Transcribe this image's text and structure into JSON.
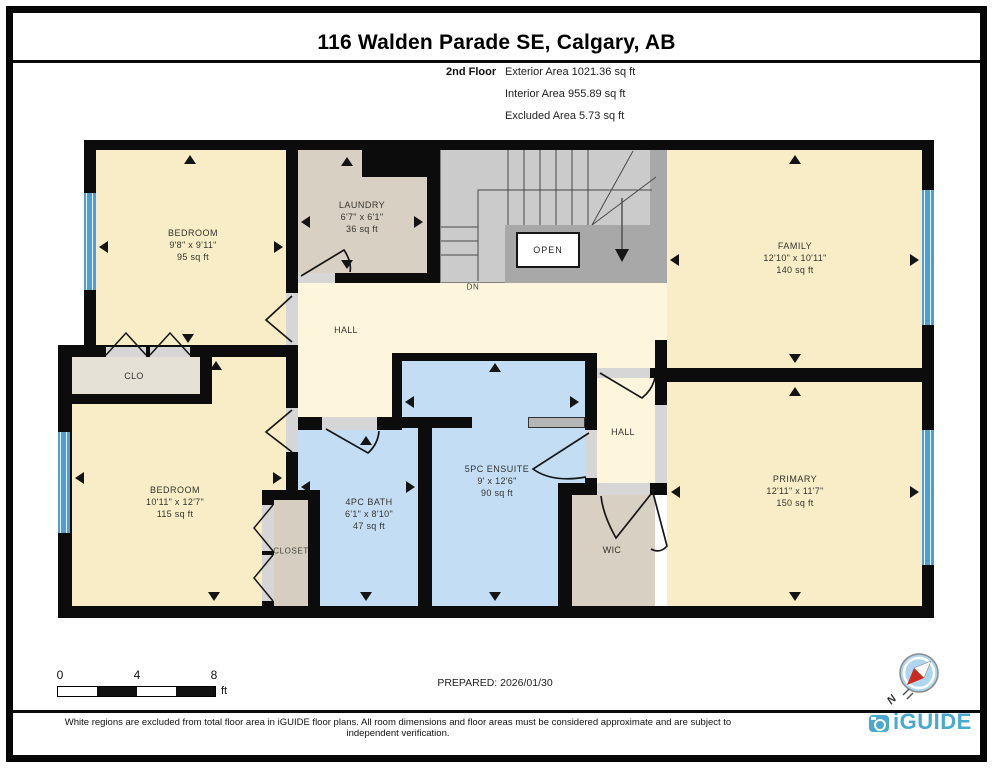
{
  "header": {
    "title": "116 Walden Parade SE, Calgary, AB",
    "floor_label": "2nd Floor",
    "stats": [
      "Exterior Area 1021.36 sq ft",
      "Interior Area 955.89 sq ft",
      "Excluded Area 5.73 sq ft"
    ]
  },
  "rooms": {
    "bedroom1": {
      "name": "BEDROOM",
      "dims": "9'8\" x 9'11\"",
      "area": "95 sq ft"
    },
    "laundry": {
      "name": "LAUNDRY",
      "dims": "6'7\" x 6'1\"",
      "area": "36 sq ft"
    },
    "family": {
      "name": "FAMILY",
      "dims": "12'10\" x 10'11\"",
      "area": "140 sq ft"
    },
    "bedroom2": {
      "name": "BEDROOM",
      "dims": "10'11\" x 12'7\"",
      "area": "115 sq ft"
    },
    "bath": {
      "name": "4PC BATH",
      "dims": "6'1\" x 8'10\"",
      "area": "47 sq ft"
    },
    "ensuite": {
      "name": "5PC ENSUITE",
      "dims": "9' x 12'6\"",
      "area": "90 sq ft"
    },
    "primary": {
      "name": "PRIMARY",
      "dims": "12'11\" x 11'7\"",
      "area": "150 sq ft"
    },
    "hall_upper": "HALL",
    "hall_lower": "HALL",
    "wic": "WIC",
    "clo": "CLO",
    "closet": "CLOSET",
    "open": "OPEN",
    "dn": "DN"
  },
  "scale_bar": {
    "tick0": "0",
    "tick4": "4",
    "tick8": "8",
    "unit": "ft"
  },
  "prepared_label": "PREPARED: 2026/01/30",
  "compass": {
    "north_label": "N"
  },
  "footer": {
    "disclaimer": "White regions are excluded from total floor area in iGUIDE floor plans. All room dimensions and floor areas must be considered approximate and are subject to independent verification.",
    "brand": "iGUIDE"
  },
  "colors": {
    "wall": "#0c0c0c",
    "room_cream": "#f8edc6",
    "hall_cream": "#fdf6dc",
    "tan": "#d8d0c2",
    "clo_gray": "#e5e1d6",
    "blue_room": "#c3def4",
    "window_blue": "#4f9fd4",
    "stairs_gray": "#cbcbcb",
    "stairs_frame": "#a8a8a8",
    "brand_blue": "#4aa9cc",
    "compass_red": "#cc2a20"
  }
}
